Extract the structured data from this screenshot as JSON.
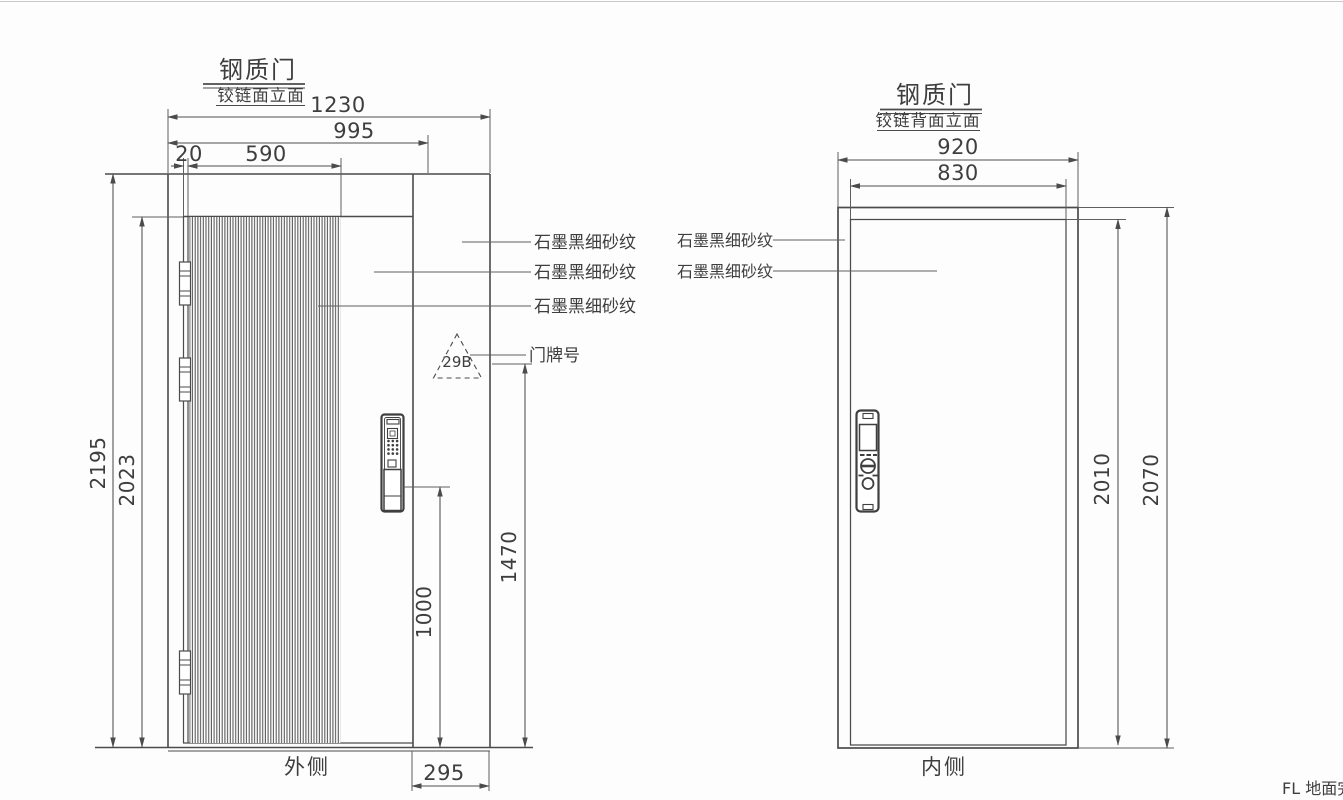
{
  "canvas": {
    "bg": "#fdfdfd",
    "line_color": "#4b4b4b",
    "text_color": "#3e3e3e"
  },
  "left": {
    "title": "钢质门",
    "subtitle": "铰链面立面",
    "side": "外侧",
    "dims": {
      "total_width": "1230",
      "frame_width": "995",
      "hinge_gap": "20",
      "ribbed_width": "590",
      "total_height": "2195",
      "leaf_height": "2023",
      "plate_height": "1470",
      "lock_height": "1000",
      "side_panel_width": "295"
    },
    "labels": {
      "finish_panel": "石墨黑细砂纹",
      "finish_face": "石墨黑细砂纹",
      "finish_ribbed": "石墨黑细砂纹",
      "plate_label": "门牌号",
      "plate_number": "29B"
    }
  },
  "right": {
    "title": "钢质门",
    "subtitle": "铰链背面立面",
    "side": "内侧",
    "dims": {
      "frame_width": "920",
      "leaf_width": "830",
      "leaf_height": "2010",
      "frame_height": "2070"
    },
    "labels": {
      "finish_frame": "石墨黑细砂纹",
      "finish_face": "石墨黑细砂纹"
    }
  },
  "footer": {
    "floor_line": "FL 地面完"
  }
}
